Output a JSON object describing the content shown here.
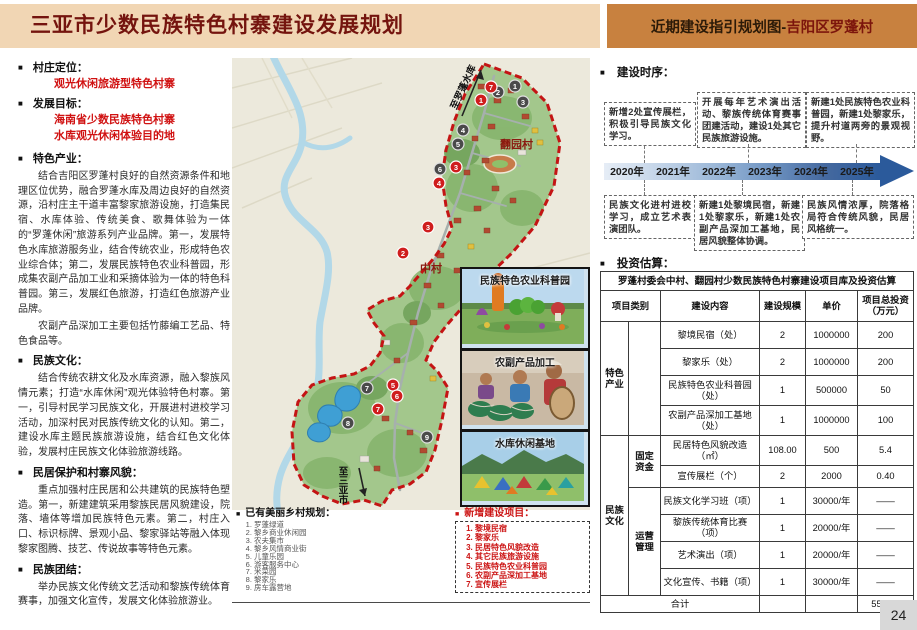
{
  "header": {
    "title": "三亚市少数民族特色村寨建设发展规划",
    "right_prefix": "近期建设指引规划图-",
    "right_suffix": "吉阳区罗蓬村"
  },
  "left": {
    "s1_title": "村庄定位：",
    "s1_value": "观光休闲旅游型特色村寨",
    "s2_title": "发展目标：",
    "s2_line1": "海南省少数民族特色村寨",
    "s2_line2": "水库观光休闲体验目的地",
    "s3_title": "特色产业：",
    "s3_p1": "结合吉阳区罗蓬村良好的自然资源条件和地理区位优势，融合罗蓬水库及周边良好的自然资源，沿村庄主干道丰富黎家旅游设施，打造集民宿、水库体验、传统美食、歌舞体验为一体的“罗蓬休闲”旅游系列产业品牌。第一，发展特色水库旅游服务业，结合传统农业，形成特色农业综合体；第二，发展民族特色农业科普园，形成集农副产品加工业和采摘体验为一体的特色科普园。第三，发展红色旅游，打造红色旅游产业品牌。",
    "s3_p2": "农副产品深加工主要包括竹藤编工艺品、特色食品等。",
    "s4_title": "民族文化：",
    "s4_p1": "结合传统农耕文化及水库资源，融入黎族风情元素；打造“水库休闲”观光体验特色村寨。第一，引导村民学习民族文化，开展进村进校学习活动，加深村民对民族传统文化的认知。第二，建设水库主题民族旅游设施，结合红色文化体验，发展村庄民族文化体验旅游线路。",
    "s5_title": "民居保护和村寨风貌：",
    "s5_p1": "重点加强村庄民居和公共建筑的民族特色塑造。第一，新建建筑采用黎族民居风貌建设，院落、墙体等增加民族特色元素。第二，村庄入口、标识标牌、景观小品、黎家驿站等融入体现黎家图腾、技艺、传说故事等特色元素。",
    "s6_title": "民族团结：",
    "s6_p1": "举办民族文化传统文艺活动和黎族传统体育赛事，加强文化宣传，发展文化体验旅游业。"
  },
  "map": {
    "label_village_north": "翻园村",
    "label_village_mid": "中村",
    "arrow_top": "至罗蓬水库",
    "arrow_bottom": "至三亚市",
    "photos": [
      {
        "title": "民族特色农业科普园"
      },
      {
        "title": "农副产品加工"
      },
      {
        "title": "水库休闲基地"
      }
    ],
    "markers_new": [
      {
        "n": "7",
        "x": 259,
        "y": 29
      },
      {
        "n": "1",
        "x": 249,
        "y": 42
      },
      {
        "n": "3",
        "x": 224,
        "y": 109
      },
      {
        "n": "4",
        "x": 207,
        "y": 125
      },
      {
        "n": "3",
        "x": 196,
        "y": 169
      },
      {
        "n": "2",
        "x": 171,
        "y": 195
      },
      {
        "n": "5",
        "x": 161,
        "y": 327
      },
      {
        "n": "6",
        "x": 165,
        "y": 338
      },
      {
        "n": "7",
        "x": 146,
        "y": 351
      }
    ],
    "markers_existing": [
      {
        "n": "1",
        "x": 283,
        "y": 28
      },
      {
        "n": "2",
        "x": 266,
        "y": 34
      },
      {
        "n": "3",
        "x": 291,
        "y": 44
      },
      {
        "n": "4",
        "x": 231,
        "y": 72
      },
      {
        "n": "5",
        "x": 226,
        "y": 86
      },
      {
        "n": "6",
        "x": 208,
        "y": 111
      },
      {
        "n": "7",
        "x": 135,
        "y": 330
      },
      {
        "n": "8",
        "x": 116,
        "y": 365
      },
      {
        "n": "9",
        "x": 195,
        "y": 379
      }
    ]
  },
  "legend": {
    "existing_title": "已有美丽乡村规划：",
    "existing_items": [
      "罗蓬绿道",
      "黎乡商业休闲园",
      "农夫集市",
      "黎乡风情商业街",
      "儿童乐园",
      "游客服务中心",
      "米菜园",
      "黎家乐",
      "房车露营地"
    ],
    "new_title": "新增建设项目：",
    "new_items": [
      "黎境民宿",
      "黎家乐",
      "民居特色风貌改造",
      "其它民族旅游设施",
      "民族特色农业科普园",
      "农副产品深加工基地",
      "宣传展栏"
    ]
  },
  "timeline": {
    "section_title": "建设时序：",
    "years": [
      "2020年",
      "2021年",
      "2022年",
      "2023年",
      "2024年",
      "2025年"
    ],
    "top_boxes": [
      "新增2处宣传展栏，积极引导民族文化学习。",
      "开展每年艺术演出活动、黎族传统体育赛事团建活动，建设1处其它民族旅游设施。",
      "新建1处民族特色农业科普园，新建1处黎家乐，提升村道两旁的景观视野。"
    ],
    "bottom_boxes": [
      "民族文化进村进校学习，成立艺术表演团队。",
      "新建1处黎境民宿，新建1处黎家乐，新建1处农副产品深加工基地，民居风貌整体协调。",
      "民族风情浓厚，院落格局符合传统风貌，民居风格统一。"
    ]
  },
  "invest": {
    "section_title": "投资估算：",
    "table_title": "罗蓬村委会中村、翻园村少数民族特色村寨建设项目库及投资估算",
    "headers": [
      "项目类别",
      "建设内容",
      "建设规模",
      "单价",
      "项目总投资（万元）"
    ],
    "cat1": "特色产业",
    "cat2": "民族文化",
    "sub_fixed": "固定资金",
    "sub_oper": "运营管理",
    "rows": [
      {
        "content": "黎境民宿（处）",
        "scale": "2",
        "unit": "1000000",
        "total": "200"
      },
      {
        "content": "黎家乐（处）",
        "scale": "2",
        "unit": "1000000",
        "total": "200"
      },
      {
        "content": "民族特色农业科普园（处）",
        "scale": "1",
        "unit": "500000",
        "total": "50"
      },
      {
        "content": "农副产品深加工基地（处）",
        "scale": "1",
        "unit": "1000000",
        "total": "100"
      },
      {
        "content": "民居特色风貌改造（㎡）",
        "scale": "108.00",
        "unit": "500",
        "total": "5.4"
      },
      {
        "content": "宣传展栏（个）",
        "scale": "2",
        "unit": "2000",
        "total": "0.40"
      },
      {
        "content": "民族文化学习班（项）",
        "scale": "1",
        "unit": "30000/年",
        "total": "——"
      },
      {
        "content": "黎族传统体育比赛（项）",
        "scale": "1",
        "unit": "20000/年",
        "total": "——"
      },
      {
        "content": "艺术演出（项）",
        "scale": "1",
        "unit": "20000/年",
        "total": "——"
      },
      {
        "content": "文化宣传、书籍（项）",
        "scale": "1",
        "unit": "30000/年",
        "total": "——"
      }
    ],
    "total_label": "合计",
    "total_value": "555.80"
  },
  "page_number": "24",
  "colors": {
    "header_bg": "#f1d6b4",
    "header_accent_bg": "#c8813f",
    "title_red": "#74140e",
    "accent_red": "#d01111",
    "timeline_blue_dark": "#2b5a9b",
    "boundary_red": "#c41414",
    "map_green": "#a3c78c",
    "water_blue": "#3f9fd4"
  }
}
